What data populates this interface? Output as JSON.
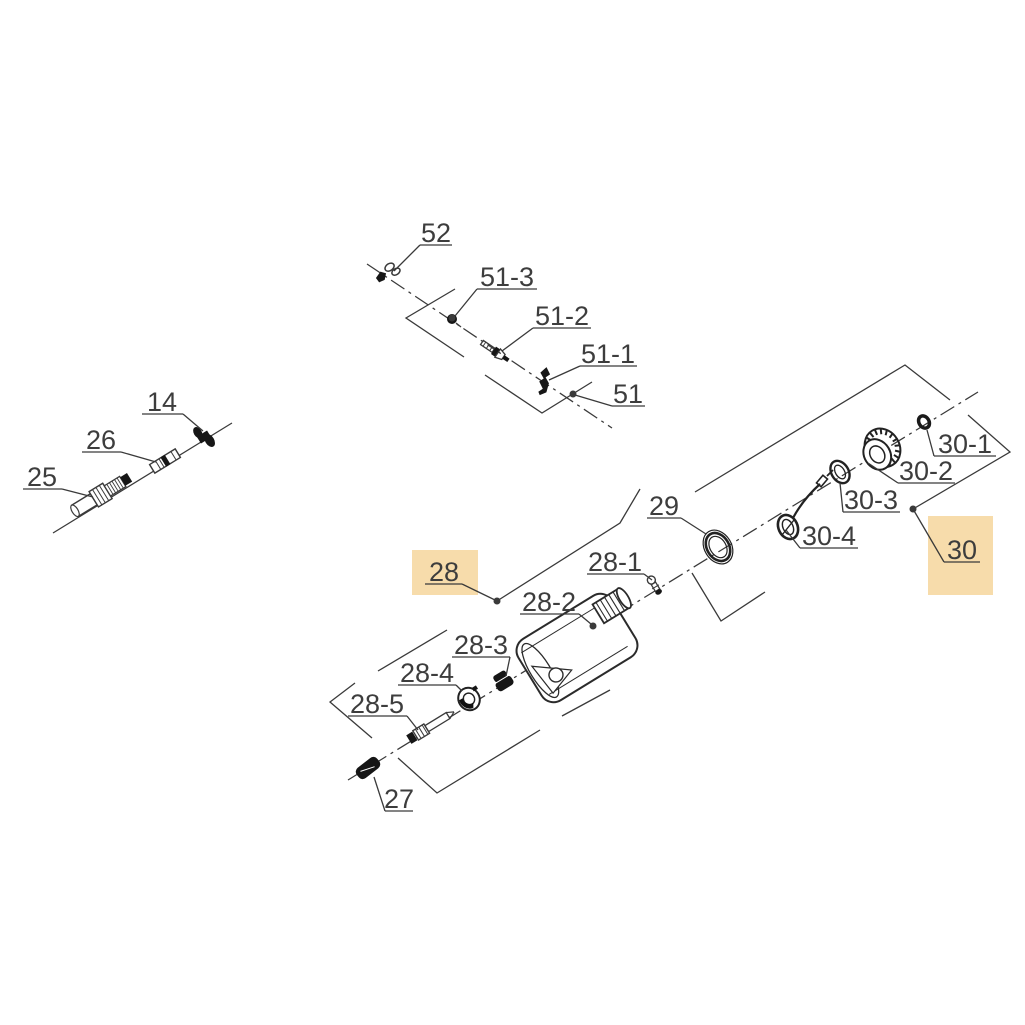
{
  "diagram": {
    "kind": "exploded-parts-diagram",
    "canvas": {
      "width": 1025,
      "height": 1025,
      "background": "#ffffff"
    },
    "colors": {
      "line": "#3a3a3a",
      "label_text": "#3d3d3d",
      "highlight": "#f7dcab",
      "part_dark": "#161616"
    },
    "axes": [
      {
        "name": "main-centerline",
        "style": "dashdot",
        "points": [
          [
            348,
            780
          ],
          [
            978,
            392
          ]
        ]
      },
      {
        "name": "upper-group-centerline",
        "style": "dashdot",
        "points": [
          [
            367,
            264
          ],
          [
            612,
            428
          ]
        ]
      },
      {
        "name": "throttle-cable-line",
        "style": "solid",
        "points": [
          [
            53,
            533
          ],
          [
            232,
            423
          ]
        ]
      }
    ],
    "brackets": [
      {
        "name": "bracket-51-left",
        "points": [
          [
            455,
            289
          ],
          [
            406,
            318
          ],
          [
            464,
            357
          ]
        ]
      },
      {
        "name": "bracket-51-right",
        "points": [
          [
            485,
            375
          ],
          [
            542,
            413
          ],
          [
            592,
            382
          ]
        ]
      },
      {
        "name": "bracket-28-upper",
        "points": [
          [
            497,
            601
          ],
          [
            620,
            523
          ],
          [
            640,
            489
          ]
        ]
      },
      {
        "name": "bracket-28-right",
        "points": [
          [
            692,
            573
          ],
          [
            721,
            621
          ],
          [
            765,
            592
          ]
        ]
      },
      {
        "name": "bracket-28-lower",
        "points": [
          [
            398,
            758
          ],
          [
            437,
            793
          ],
          [
            540,
            730
          ]
        ]
      },
      {
        "name": "bracket-28-lower-2",
        "points": [
          [
            562,
            716
          ],
          [
            610,
            690
          ]
        ]
      },
      {
        "name": "bracket-28-5-left",
        "points": [
          [
            355,
            683
          ],
          [
            330,
            702
          ],
          [
            372,
            738
          ]
        ]
      },
      {
        "name": "bracket-28-4-upper",
        "points": [
          [
            378,
            671
          ],
          [
            447,
            630
          ]
        ]
      },
      {
        "name": "bracket-30-left",
        "points": [
          [
            695,
            492
          ],
          [
            905,
            365
          ],
          [
            950,
            400
          ]
        ]
      },
      {
        "name": "bracket-30-right",
        "points": [
          [
            968,
            415
          ],
          [
            1010,
            452
          ],
          [
            913,
            509
          ]
        ]
      }
    ],
    "labels": [
      {
        "id": "52",
        "text": "52",
        "cx": 436,
        "baseline": 242,
        "underline": [
          420,
          452,
          245
        ],
        "leader": [
          [
            420,
            245
          ],
          [
            394,
            271
          ]
        ]
      },
      {
        "id": "51-3",
        "text": "51-3",
        "cx": 507,
        "baseline": 286,
        "underline": [
          477,
          537,
          289
        ],
        "leader": [
          [
            477,
            289
          ],
          [
            455,
            316
          ]
        ],
        "dot": [
          452,
          318
        ]
      },
      {
        "id": "51-2",
        "text": "51-2",
        "cx": 562,
        "baseline": 325,
        "underline": [
          533,
          591,
          328
        ],
        "leader": [
          [
            533,
            328
          ],
          [
            502,
            351
          ]
        ]
      },
      {
        "id": "51-1",
        "text": "51-1",
        "cx": 608,
        "baseline": 363,
        "underline": [
          580,
          637,
          366
        ],
        "leader": [
          [
            580,
            366
          ],
          [
            549,
            380
          ]
        ]
      },
      {
        "id": "51",
        "text": "51",
        "cx": 628,
        "baseline": 403,
        "underline": [
          612,
          645,
          406
        ],
        "leader": [
          [
            612,
            406
          ],
          [
            575,
            395
          ]
        ],
        "dot": [
          573,
          394
        ]
      },
      {
        "id": "14",
        "text": "14",
        "cx": 162,
        "baseline": 411,
        "underline": [
          142,
          183,
          414
        ],
        "leader": [
          [
            183,
            414
          ],
          [
            203,
            431
          ]
        ]
      },
      {
        "id": "26",
        "text": "26",
        "cx": 101,
        "baseline": 449,
        "underline": [
          82,
          121,
          452
        ],
        "leader": [
          [
            121,
            452
          ],
          [
            156,
            462
          ]
        ]
      },
      {
        "id": "25",
        "text": "25",
        "cx": 42,
        "baseline": 486,
        "underline": [
          23,
          62,
          489
        ],
        "leader": [
          [
            62,
            489
          ],
          [
            93,
            497
          ]
        ]
      },
      {
        "id": "29",
        "text": "29",
        "cx": 664,
        "baseline": 515,
        "underline": [
          647,
          681,
          518
        ],
        "leader": [
          [
            681,
            518
          ],
          [
            706,
            534
          ]
        ]
      },
      {
        "id": "28-1",
        "text": "28-1",
        "cx": 615,
        "baseline": 571,
        "underline": [
          587,
          644,
          574
        ],
        "leader": [
          [
            644,
            574
          ],
          [
            652,
            580
          ]
        ]
      },
      {
        "id": "28-2",
        "text": "28-2",
        "cx": 549,
        "baseline": 611,
        "underline": [
          520,
          579,
          614
        ],
        "leader": [
          [
            579,
            614
          ],
          [
            591,
            624
          ]
        ],
        "dot": [
          593,
          626
        ]
      },
      {
        "id": "28",
        "text": "28",
        "cx": 444,
        "baseline": 581,
        "underline": [
          425,
          462,
          584
        ],
        "leader": [
          [
            462,
            584
          ],
          [
            495,
            600
          ]
        ],
        "dot": [
          497,
          601
        ],
        "highlight": [
          412,
          550,
          66,
          45
        ]
      },
      {
        "id": "28-3",
        "text": "28-3",
        "cx": 481,
        "baseline": 654,
        "underline": [
          452,
          510,
          657
        ],
        "leader": [
          [
            510,
            657
          ],
          [
            506,
            676
          ]
        ]
      },
      {
        "id": "28-4",
        "text": "28-4",
        "cx": 427,
        "baseline": 682,
        "underline": [
          398,
          456,
          685
        ],
        "leader": [
          [
            456,
            685
          ],
          [
            462,
            691
          ]
        ]
      },
      {
        "id": "28-5",
        "text": "28-5",
        "cx": 377,
        "baseline": 713,
        "underline": [
          348,
          407,
          716
        ],
        "leader": [
          [
            407,
            716
          ],
          [
            418,
            730
          ]
        ]
      },
      {
        "id": "27",
        "text": "27",
        "cx": 399,
        "baseline": 808,
        "underline": [
          385,
          413,
          811
        ],
        "leader": [
          [
            385,
            811
          ],
          [
            374,
            777
          ]
        ]
      },
      {
        "id": "30-1",
        "text": "30-1",
        "cx": 965,
        "baseline": 453,
        "underline": [
          934,
          996,
          456
        ],
        "leader": [
          [
            934,
            456
          ],
          [
            927,
            430
          ]
        ]
      },
      {
        "id": "30-2",
        "text": "30-2",
        "cx": 926,
        "baseline": 480,
        "underline": [
          898,
          955,
          483
        ],
        "leader": [
          [
            898,
            483
          ],
          [
            868,
            463
          ]
        ]
      },
      {
        "id": "30-3",
        "text": "30-3",
        "cx": 871,
        "baseline": 509,
        "underline": [
          843,
          900,
          512
        ],
        "leader": [
          [
            843,
            512
          ],
          [
            840,
            483
          ]
        ]
      },
      {
        "id": "30-4",
        "text": "30-4",
        "cx": 829,
        "baseline": 545,
        "underline": [
          800,
          858,
          548
        ],
        "leader": [
          [
            800,
            548
          ],
          [
            786,
            530
          ]
        ]
      },
      {
        "id": "30",
        "text": "30",
        "cx": 962,
        "baseline": 559,
        "underline": [
          944,
          980,
          562
        ],
        "leader": [
          [
            944,
            562
          ],
          [
            913,
            509
          ]
        ],
        "dot": [
          913,
          509
        ],
        "highlight": [
          928,
          516,
          65,
          79
        ]
      }
    ],
    "parts": [
      {
        "name": "retaining-clip-52",
        "type": "clip52",
        "x": 387,
        "y": 273,
        "rot": -15
      },
      {
        "name": "screw-51-3",
        "type": "dotpart",
        "x": 452,
        "y": 319,
        "rot": 0
      },
      {
        "name": "screw-assembly-51-2",
        "type": "screw",
        "x": 496,
        "y": 352,
        "rot": 34
      },
      {
        "name": "spring-clip-51-1",
        "type": "zclip",
        "x": 542,
        "y": 381,
        "rot": 34
      },
      {
        "name": "cable-clamp-14",
        "type": "clamp",
        "x": 204,
        "y": 437,
        "rot": -31.5
      },
      {
        "name": "cable-coupler-26",
        "type": "coupler",
        "x": 165,
        "y": 461,
        "rot": -31.5
      },
      {
        "name": "cable-adjuster-25",
        "type": "adjuster",
        "x": 104,
        "y": 493,
        "rot": -31.5
      },
      {
        "name": "seal-ring-30-1",
        "type": "darkring",
        "x": 924,
        "y": 422,
        "rot": -31.5
      },
      {
        "name": "fuel-cap-30-2",
        "type": "cap",
        "x": 881,
        "y": 451,
        "rot": -31.5
      },
      {
        "name": "cap-gasket-30-3",
        "type": "ring2",
        "x": 840,
        "y": 472,
        "rot": -31.5
      },
      {
        "name": "cap-retainer-30-4",
        "type": "retainer",
        "x": 788,
        "y": 527,
        "rot": 0
      },
      {
        "name": "o-ring-29",
        "type": "ring3",
        "x": 718,
        "y": 547,
        "rot": -31.5
      },
      {
        "name": "vent-valve-28-1",
        "type": "valve",
        "x": 655,
        "y": 586,
        "rot": -31.5
      },
      {
        "name": "fuel-tank-28-2",
        "type": "tank",
        "x": 577,
        "y": 648,
        "rot": -31.5
      },
      {
        "name": "grommet-28-3",
        "type": "grommet",
        "x": 503,
        "y": 681,
        "rot": -31.5
      },
      {
        "name": "bushing-28-4",
        "type": "primer",
        "x": 469,
        "y": 699,
        "rot": -31.5
      },
      {
        "name": "pickup-tube-28-5",
        "type": "pickup",
        "x": 431,
        "y": 726,
        "rot": -31.5
      },
      {
        "name": "fuel-filter-27",
        "type": "filter",
        "x": 368,
        "y": 768,
        "rot": -38
      }
    ]
  }
}
